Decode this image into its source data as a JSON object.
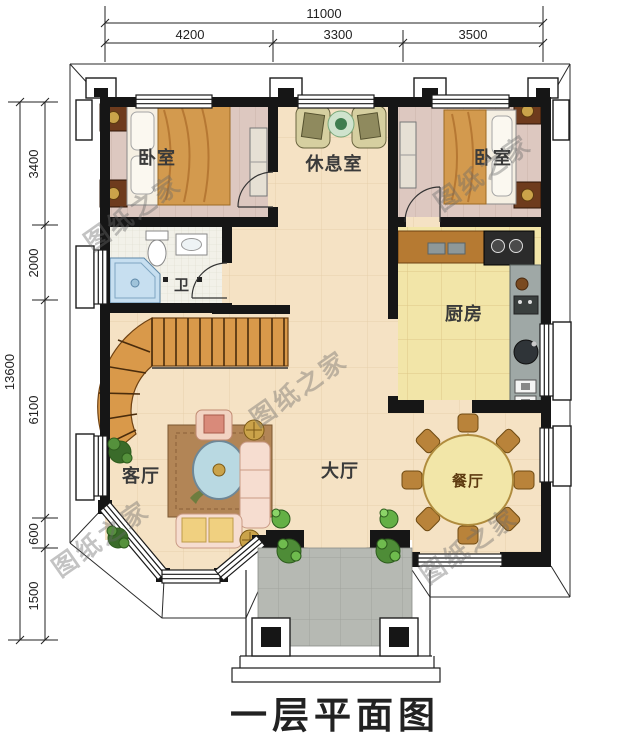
{
  "title": "一层平面图",
  "watermark": "图纸之家",
  "dimensions": {
    "top": {
      "total": "11000",
      "segments": [
        "4200",
        "3300",
        "3500"
      ]
    },
    "left": {
      "total": "13600",
      "segments": [
        "3400",
        "2000",
        "6100",
        "600",
        "1500"
      ]
    }
  },
  "rooms": {
    "bedroom_left": "卧室",
    "lounge": "休息室",
    "bedroom_right": "卧室",
    "bathroom": "卫",
    "kitchen": "厨房",
    "living_room": "客厅",
    "hall": "大厅",
    "dining": "餐厅"
  },
  "colors": {
    "wall": "#161616",
    "ink": "#222222",
    "floor_cream": "#f5e2c4",
    "floor_bedroom": "#ddc8c0",
    "floor_kitchen": "#f2e5a8",
    "floor_bath": "#f2f1e9",
    "porch_gray": "#b6b9b3",
    "stair_wood": "#d9994a",
    "accent_gold": "#caa34a",
    "shower_blue": "#c7dff0",
    "plant_green": "#4e8c37"
  }
}
